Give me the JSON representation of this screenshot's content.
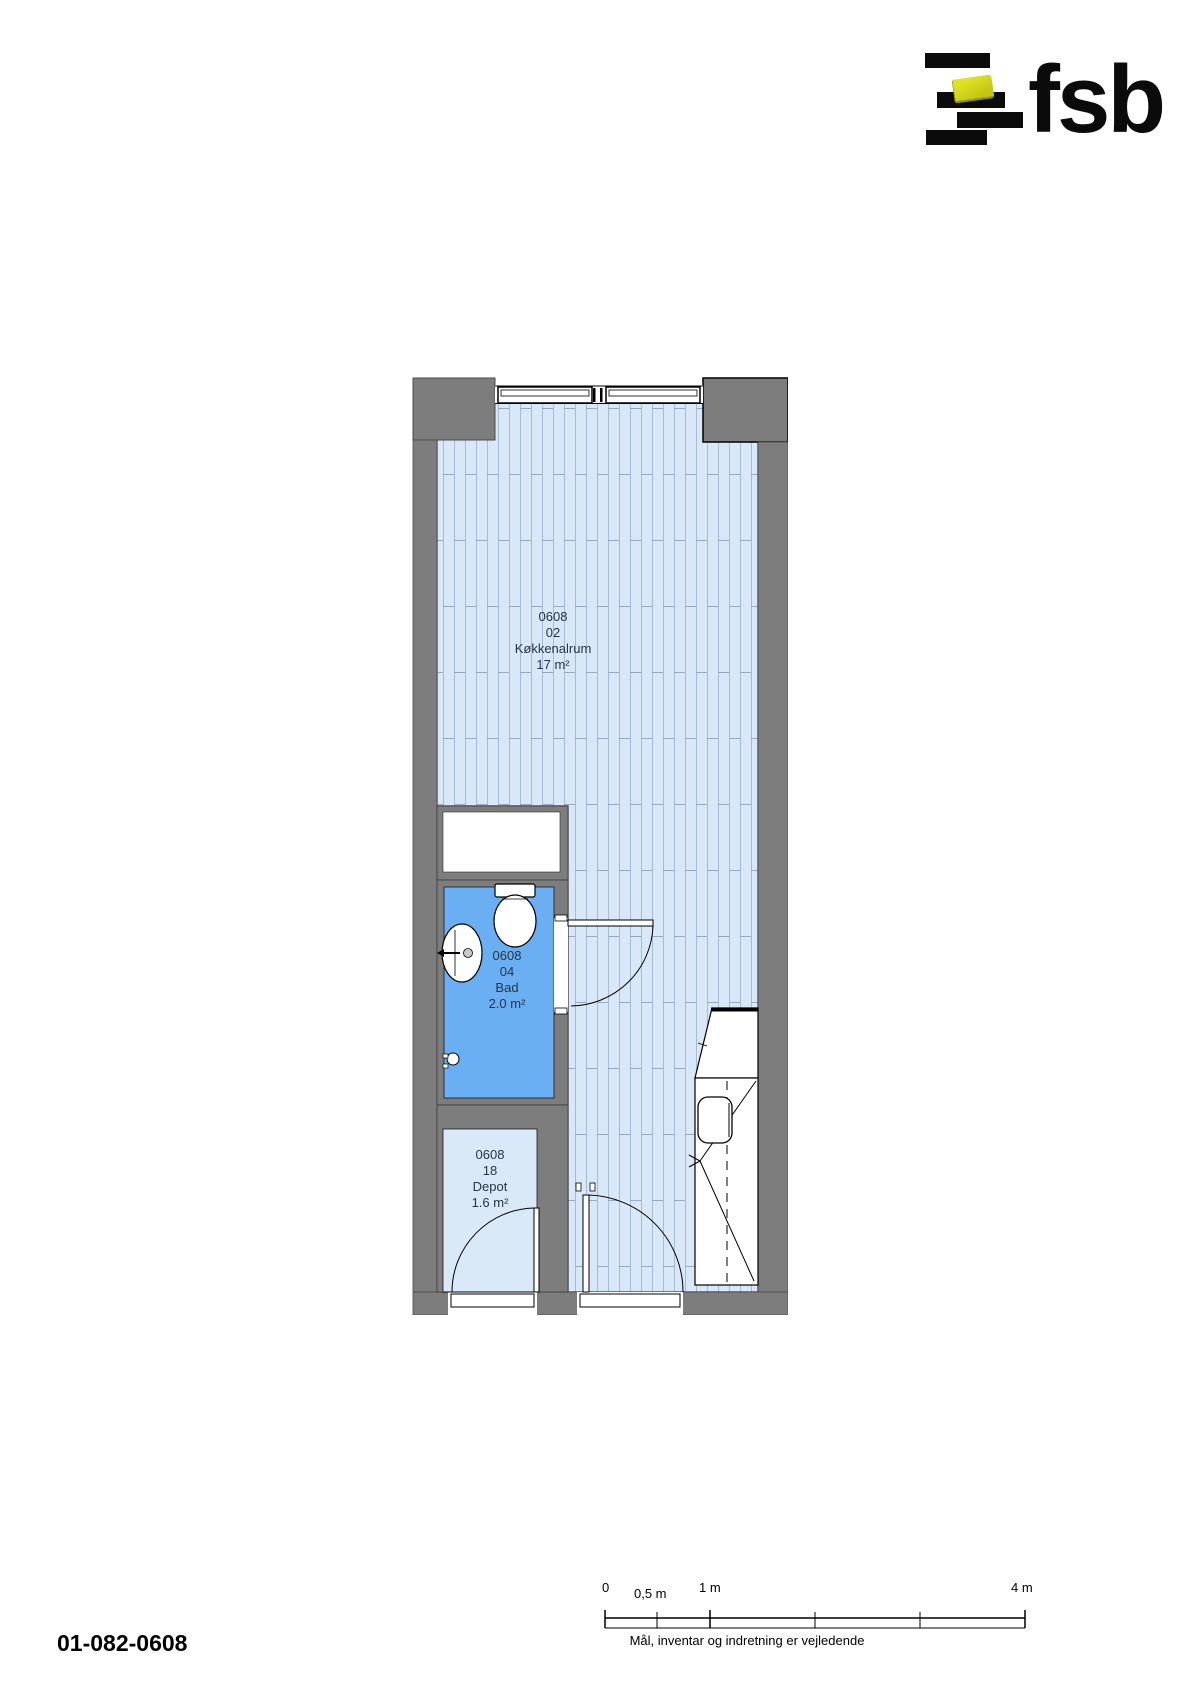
{
  "logo": {
    "brand": "fsb"
  },
  "plan": {
    "rooms": [
      {
        "id": "0608",
        "number": "02",
        "name": "Køkkenalrum",
        "area": "17 m²"
      },
      {
        "id": "0608",
        "number": "04",
        "name": "Bad",
        "area": "2.0 m²"
      },
      {
        "id": "0608",
        "number": "18",
        "name": "Depot",
        "area": "1.6 m²"
      }
    ]
  },
  "scale_bar": {
    "labels": {
      "zero": "0",
      "half": "0,5 m",
      "one": "1 m",
      "four": "4 m"
    }
  },
  "footer": {
    "drawing_number": "01-082-0608",
    "disclaimer": "Mål, inventar og indretning er vejledende"
  },
  "colors": {
    "wall_gray": "#7d7d7d",
    "floor_blue": "#d9e8f8",
    "bath_blue": "#6aaff2",
    "depot_blue": "#d9e9f8",
    "logo_yellow": "#ced31c"
  }
}
